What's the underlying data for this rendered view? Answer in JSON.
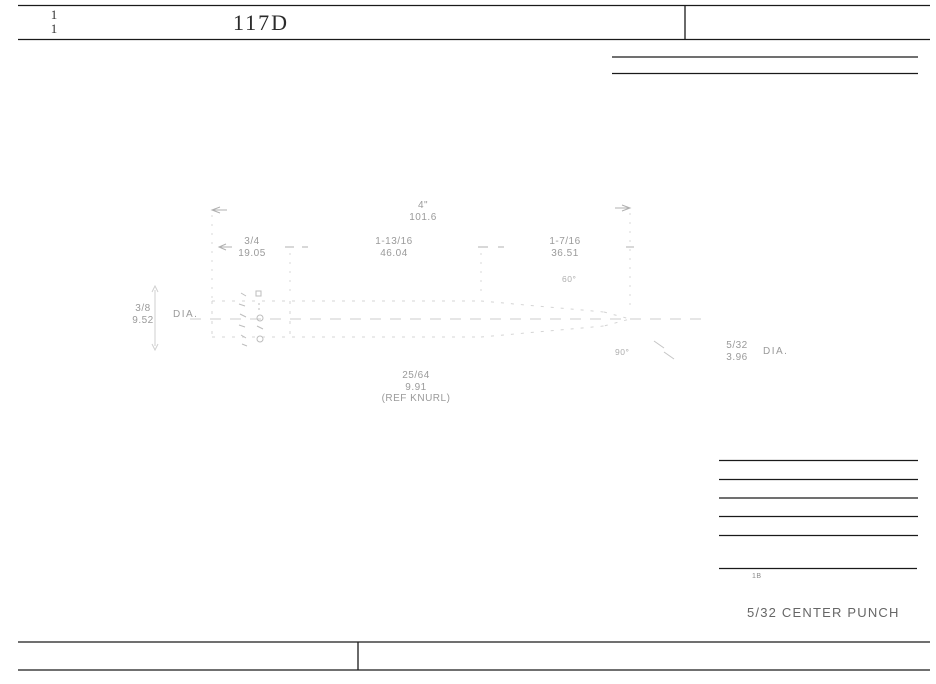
{
  "header": {
    "sheet_top": "1",
    "sheet_bottom": "1",
    "drawing_number": "117D"
  },
  "dimensions": {
    "overall": {
      "inches": "4\"",
      "mm": "101.6"
    },
    "knurl_length": {
      "inches": "3/4",
      "mm": "19.05"
    },
    "body_length": {
      "inches": "1-13/16",
      "mm": "46.04"
    },
    "taper_length": {
      "inches": "1-7/16",
      "mm": "36.51"
    },
    "body_diameter": {
      "inches": "3/8",
      "mm": "9.52",
      "suffix": "DIA."
    },
    "point_diameter": {
      "inches": "5/32",
      "mm": "3.96",
      "suffix": "DIA."
    },
    "knurl_diameter": {
      "inches": "25/64",
      "mm": "9.91",
      "note": "(REF KNURL)"
    },
    "taper_angle": "60°",
    "point_angle": "90°"
  },
  "title_block": {
    "part_name": "5/32 CENTER PUNCH",
    "note_mark": "1B"
  },
  "colors": {
    "line": "#1a1a1a",
    "faint_line": "#c9c9c9",
    "dim_text": "#9a9a9a",
    "part_name_text": "#666666",
    "header_text": "#2b2b2b"
  }
}
